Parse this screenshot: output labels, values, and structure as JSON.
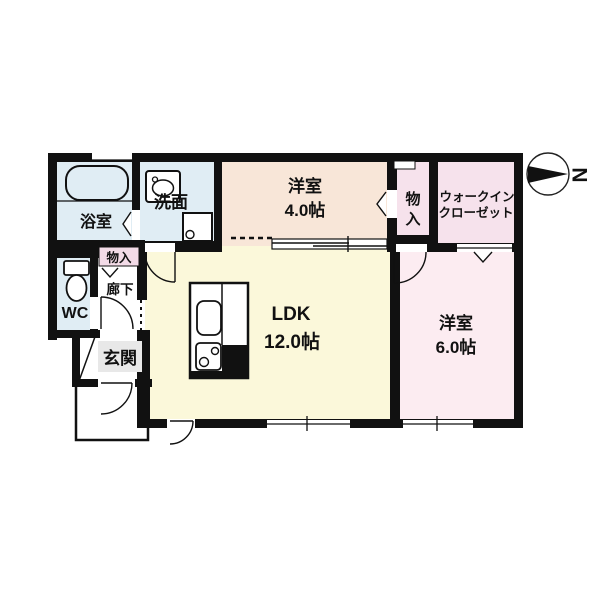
{
  "rooms": {
    "bathroom": {
      "label": "浴室"
    },
    "washroom": {
      "label": "洗面"
    },
    "western4": {
      "label": "洋室",
      "size": "4.0帖"
    },
    "storage_top": {
      "line1": "物",
      "line2": "入"
    },
    "wic": {
      "line1": "ウォークイン",
      "line2": "クローゼット"
    },
    "wc": {
      "label": "WC"
    },
    "storage_hall": {
      "label": "物入"
    },
    "hallway": {
      "label": "廊下"
    },
    "entrance": {
      "label": "玄関"
    },
    "ldk": {
      "label": "LDK",
      "size": "12.0帖"
    },
    "western6": {
      "label": "洋室",
      "size": "6.0帖"
    }
  },
  "compass": {
    "letter": "N"
  },
  "colors": {
    "wet_rooms": "#e0edf4",
    "western_room_4": "#f8e6d8",
    "closet_pink": "#f6e2ec",
    "western_room_6": "#fcecf1",
    "ldk": "#fbf8da",
    "storage_hall": "#f3dbe7",
    "entrance_box": "#e8e8e8",
    "corridor": "#ffffff",
    "wall": "#111111"
  }
}
